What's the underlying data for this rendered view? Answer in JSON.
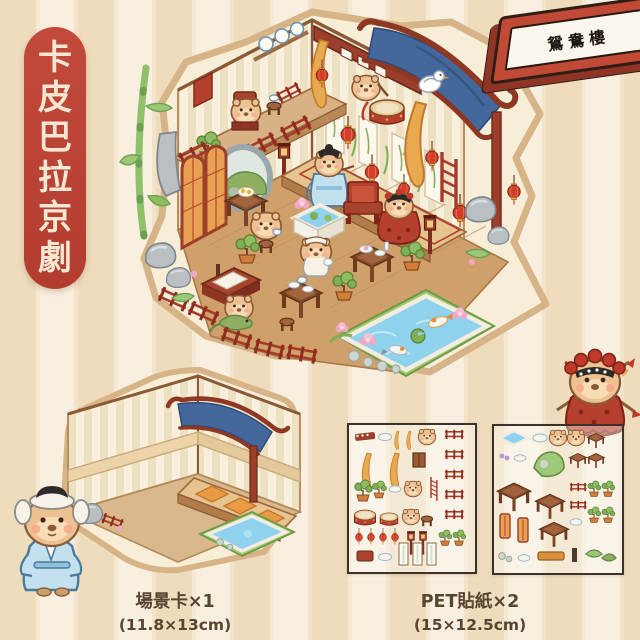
{
  "page": {
    "type": "product-visual",
    "theme": "capybara-beijing-opera-paper-scene-sticker-set"
  },
  "title": {
    "full": "卡皮巴拉京劇",
    "chars": [
      "卡",
      "皮",
      "巴",
      "拉",
      "京",
      "劇"
    ],
    "pill_color": "#bc4334",
    "text_color": "#f6e7d2"
  },
  "banner": {
    "text": "鴛鴦樓",
    "frame_color": "#c14a36",
    "plaque_color": "#fcf7ec",
    "text_color": "#1c1410"
  },
  "products": {
    "scene_card": {
      "label": "場景卡×1",
      "size": "(11.8×13cm)"
    },
    "pet_stickers": {
      "label": "PET貼紙×2",
      "size": "(15×12.5cm)"
    }
  },
  "scene": {
    "description": "isometric capybara tea-house opera stage sticker",
    "colors": {
      "roof_blue": "#44679c",
      "lantern_red": "#d23f2b",
      "wood_red": "#9c3f2a",
      "pond_blue": "#8ed2ee",
      "floor_tan": "#cfa06a",
      "capybara": "#eec193",
      "bamboo_green": "#8fc06a",
      "sticker_base": "#f8eed8"
    }
  },
  "background": {
    "stripe_dark": "#eedcbd",
    "stripe_light": "#f9efe0"
  }
}
